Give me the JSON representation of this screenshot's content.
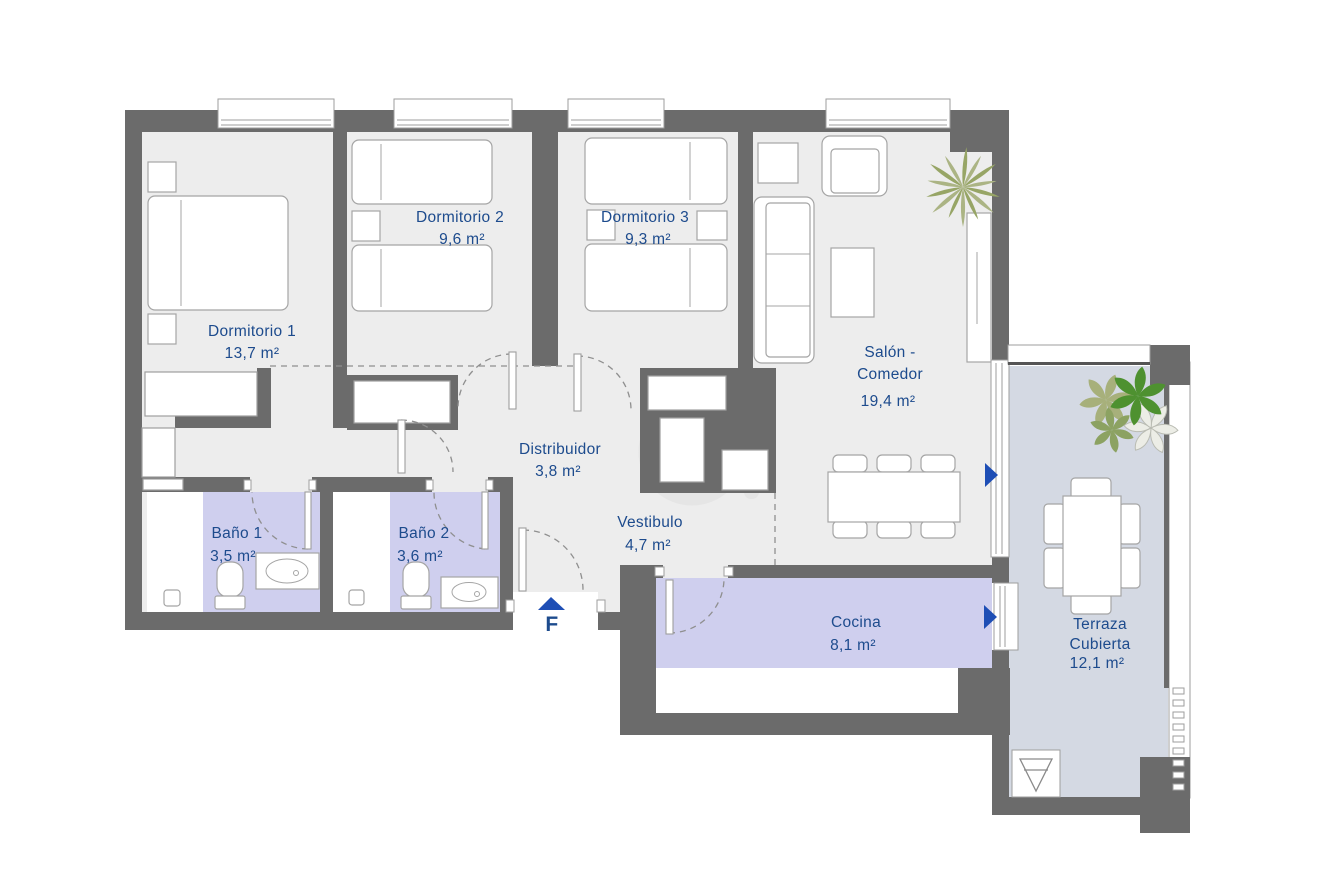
{
  "plan_type": "apartment-floor-plan",
  "rooms": {
    "dormitorio1": {
      "name": "Dormitorio 1",
      "area": "13,7 m²"
    },
    "dormitorio2": {
      "name": "Dormitorio 2",
      "area": "9,6 m²"
    },
    "dormitorio3": {
      "name": "Dormitorio 3",
      "area": "9,3 m²"
    },
    "salon": {
      "name_line1": "Salón -",
      "name_line2": "Comedor",
      "area": "19,4 m²"
    },
    "distribuidor": {
      "name": "Distribuidor",
      "area": "3,8 m²"
    },
    "vestibulo": {
      "name": "Vestibulo",
      "area": "4,7 m²"
    },
    "bano1": {
      "name": "Baño 1",
      "area": "3,5 m²"
    },
    "bano2": {
      "name": "Baño 2",
      "area": "3,6 m²"
    },
    "cocina": {
      "name": "Cocina",
      "area": "8,1 m²"
    },
    "terraza": {
      "name_line1": "Terraza",
      "name_line2": "Cubierta",
      "area": "12,1 m²"
    }
  },
  "entrance": {
    "marker": "F"
  },
  "icons": [
    "palm-plant-icon",
    "flower-plant-icon",
    "entrance-arrow-icon",
    "terrace-access-arrow-icon",
    "kitchen-access-arrow-icon",
    "drain-icon",
    "toilet-icon",
    "sink-icon",
    "shower-drain-icon"
  ],
  "colors": {
    "wall": "#6b6b6b",
    "floor": "#ededed",
    "wet_room_floor": "#cfcfee",
    "terrace_floor": "#d4d9e3",
    "label_text": "#1d4b8d",
    "arrow_blue": "#1e4eb5",
    "plant_green": "#4e9130",
    "plant_olive": "#97a566"
  }
}
